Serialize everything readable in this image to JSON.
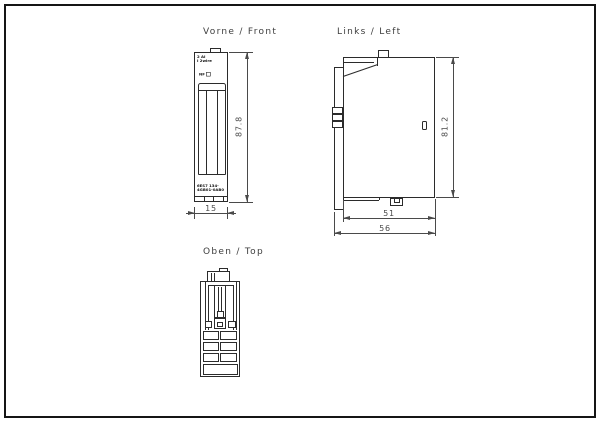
{
  "drawing": {
    "views": {
      "front": {
        "title": "Vorne / Front",
        "module_label": {
          "line1": "2 AI",
          "line2": "I 2wire"
        },
        "led_label": "NF",
        "order_number": {
          "line1": "6ES7 134-",
          "line2": "4GB01-0AB0"
        },
        "dimensions": {
          "height_mm": "87.8",
          "width_mm": "15"
        }
      },
      "left": {
        "title": "Links / Left",
        "dimensions": {
          "height_mm": "81.2",
          "depth_body_mm": "51",
          "depth_total_mm": "56"
        }
      },
      "top": {
        "title": "Oben / Top"
      }
    },
    "colors": {
      "line": "#2b2b2b",
      "dimension": "#4a4a4a",
      "frame": "#151515",
      "background": "#ffffff"
    }
  }
}
